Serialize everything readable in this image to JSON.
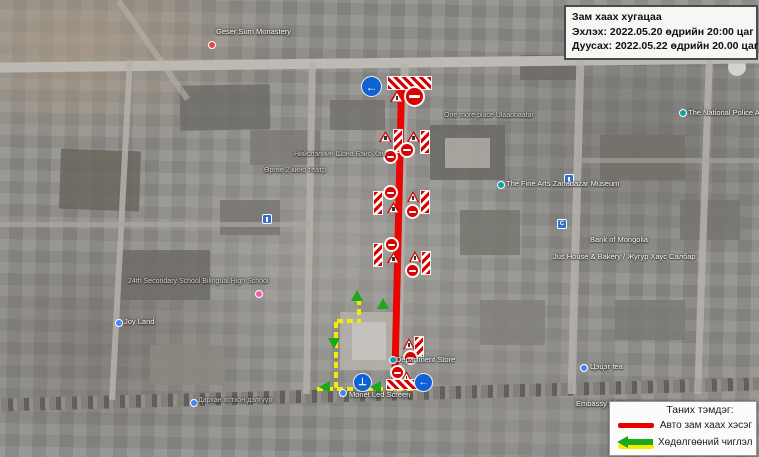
{
  "info_box": {
    "title": "Зам хаах хугацаа",
    "start_line": "Эхлэх: 2022.05.20 өдрийн 20:00 цаг",
    "end_line": "Дуусах: 2022.05.22 өдрийн 20.00 цаг"
  },
  "legend": {
    "title": "Таних тэмдэг:",
    "items": [
      {
        "key": "closed-section",
        "label": "Авто зам хаах хэсэг"
      },
      {
        "key": "traffic-direction",
        "label": "Хөдөлгөөний чиглэл"
      }
    ]
  },
  "colors": {
    "closed_route": "#ea0505",
    "detour_line_yellow": "#f4ec00",
    "detour_arrow_green": "#1ca81c",
    "no_entry_sign": "#d40202",
    "mandatory_sign_blue": "#0f62d6"
  },
  "map": {
    "labels": [
      {
        "text": "Geser Sum Monastery",
        "x": 216,
        "y": 27,
        "tone": "light"
      },
      {
        "text": "Нийслэлийн Шона Бэйс Хэм",
        "x": 294,
        "y": 151,
        "tone": "dim"
      },
      {
        "text": "Өргөө 2 кино театр",
        "x": 264,
        "y": 167,
        "tone": "dim"
      },
      {
        "text": "One more place Ulaanbaatar",
        "x": 444,
        "y": 112,
        "tone": "dim"
      },
      {
        "text": "The Fine Arts Zanabazar Museum",
        "x": 506,
        "y": 179,
        "tone": "light"
      },
      {
        "text": "Bank of Mongolia",
        "x": 590,
        "y": 235,
        "tone": "light"
      },
      {
        "text": "Jus House & Bakery / Жугур Хаус Салбар",
        "x": 553,
        "y": 252,
        "tone": "light"
      },
      {
        "text": "24th Secondary School Bilingual High School",
        "x": 128,
        "y": 278,
        "tone": "dim"
      },
      {
        "text": "Joy Land",
        "x": 124,
        "y": 317,
        "tone": "light"
      },
      {
        "text": "Цэцэг tea",
        "x": 590,
        "y": 362,
        "tone": "light"
      },
      {
        "text": "Embassy of Russia",
        "x": 576,
        "y": 399,
        "tone": "light"
      },
      {
        "text": "The National Police Age",
        "x": 688,
        "y": 108,
        "tone": "light"
      },
      {
        "text": "Monet Led Screen",
        "x": 349,
        "y": 390,
        "tone": "light"
      },
      {
        "text": "Department Store",
        "x": 396,
        "y": 355,
        "tone": "light"
      },
      {
        "text": "Дархан хотхон дэлгүүр",
        "x": 198,
        "y": 397,
        "tone": "dim"
      }
    ],
    "pois": [
      {
        "kind": "dot-red",
        "x": 208,
        "y": 41
      },
      {
        "kind": "dot-teal",
        "x": 497,
        "y": 181
      },
      {
        "kind": "dot-teal",
        "x": 679,
        "y": 109
      },
      {
        "kind": "dot-teal",
        "x": 389,
        "y": 356
      },
      {
        "kind": "dot-blue",
        "x": 115,
        "y": 319
      },
      {
        "kind": "dot-blue",
        "x": 580,
        "y": 364
      },
      {
        "kind": "dot-blue",
        "x": 339,
        "y": 389
      },
      {
        "kind": "dot-blue",
        "x": 190,
        "y": 399
      },
      {
        "kind": "dot-pink",
        "x": 255,
        "y": 290
      },
      {
        "kind": "sq-blue",
        "x": 262,
        "y": 214
      },
      {
        "kind": "sq-blue",
        "x": 564,
        "y": 174
      },
      {
        "kind": "sq-blue",
        "x": 557,
        "y": 219,
        "glyph": "C"
      }
    ],
    "signs": [
      {
        "type": "blue-circle",
        "x": 361,
        "y": 76,
        "d": 21,
        "glyph": "←"
      },
      {
        "type": "chevron-h",
        "x": 387,
        "y": 76,
        "w": 45,
        "h": 14
      },
      {
        "type": "triangle",
        "x": 390,
        "y": 90,
        "s": 14
      },
      {
        "type": "no-entry",
        "x": 404,
        "y": 86,
        "d": 21
      },
      {
        "type": "triangle",
        "x": 379,
        "y": 131,
        "s": 13
      },
      {
        "type": "chevron-v",
        "x": 393,
        "y": 129,
        "w": 10,
        "h": 24
      },
      {
        "type": "no-entry",
        "x": 383,
        "y": 149,
        "d": 15
      },
      {
        "type": "triangle",
        "x": 407,
        "y": 131,
        "s": 13
      },
      {
        "type": "chevron-v",
        "x": 420,
        "y": 130,
        "w": 10,
        "h": 24
      },
      {
        "type": "no-entry",
        "x": 399,
        "y": 142,
        "d": 16
      },
      {
        "type": "chevron-v",
        "x": 373,
        "y": 191,
        "w": 10,
        "h": 24
      },
      {
        "type": "no-entry",
        "x": 383,
        "y": 185,
        "d": 15
      },
      {
        "type": "triangle",
        "x": 387,
        "y": 202,
        "s": 13
      },
      {
        "type": "triangle",
        "x": 407,
        "y": 191,
        "s": 12
      },
      {
        "type": "chevron-v",
        "x": 420,
        "y": 190,
        "w": 10,
        "h": 24
      },
      {
        "type": "no-entry",
        "x": 405,
        "y": 204,
        "d": 15
      },
      {
        "type": "chevron-v",
        "x": 373,
        "y": 243,
        "w": 10,
        "h": 24
      },
      {
        "type": "no-entry",
        "x": 384,
        "y": 237,
        "d": 15
      },
      {
        "type": "triangle",
        "x": 387,
        "y": 252,
        "s": 13
      },
      {
        "type": "triangle",
        "x": 409,
        "y": 251,
        "s": 12
      },
      {
        "type": "chevron-v",
        "x": 421,
        "y": 251,
        "w": 10,
        "h": 24
      },
      {
        "type": "no-entry",
        "x": 405,
        "y": 263,
        "d": 15
      },
      {
        "type": "triangle",
        "x": 403,
        "y": 338,
        "s": 12
      },
      {
        "type": "chevron-v",
        "x": 414,
        "y": 336,
        "w": 10,
        "h": 21
      },
      {
        "type": "no-entry",
        "x": 403,
        "y": 350,
        "d": 15
      },
      {
        "type": "no-entry",
        "x": 390,
        "y": 365,
        "d": 15
      },
      {
        "type": "triangle",
        "x": 401,
        "y": 371,
        "s": 11
      },
      {
        "type": "chevron-h",
        "x": 386,
        "y": 379,
        "w": 33,
        "h": 11
      },
      {
        "type": "blue-circle",
        "x": 353,
        "y": 373,
        "d": 19,
        "glyph": "⊥"
      },
      {
        "type": "blue-circle",
        "x": 414,
        "y": 373,
        "d": 19,
        "glyph": "←"
      }
    ],
    "detour": {
      "segments": [
        {
          "o": "v",
          "x": 357,
          "y": 299,
          "w": 4,
          "h": 22
        },
        {
          "o": "h",
          "x": 337,
          "y": 319,
          "w": 24,
          "h": 4
        },
        {
          "o": "v",
          "x": 334,
          "y": 322,
          "w": 4,
          "h": 66
        },
        {
          "o": "h",
          "x": 317,
          "y": 387,
          "w": 110,
          "h": 4
        }
      ],
      "arrows": [
        {
          "x": 351,
          "y": 290,
          "dir": "up"
        },
        {
          "x": 377,
          "y": 298,
          "dir": "up"
        },
        {
          "x": 328,
          "y": 338,
          "dir": "down"
        },
        {
          "x": 319,
          "y": 381,
          "dir": "left"
        },
        {
          "x": 370,
          "y": 381,
          "dir": "left"
        }
      ]
    }
  }
}
